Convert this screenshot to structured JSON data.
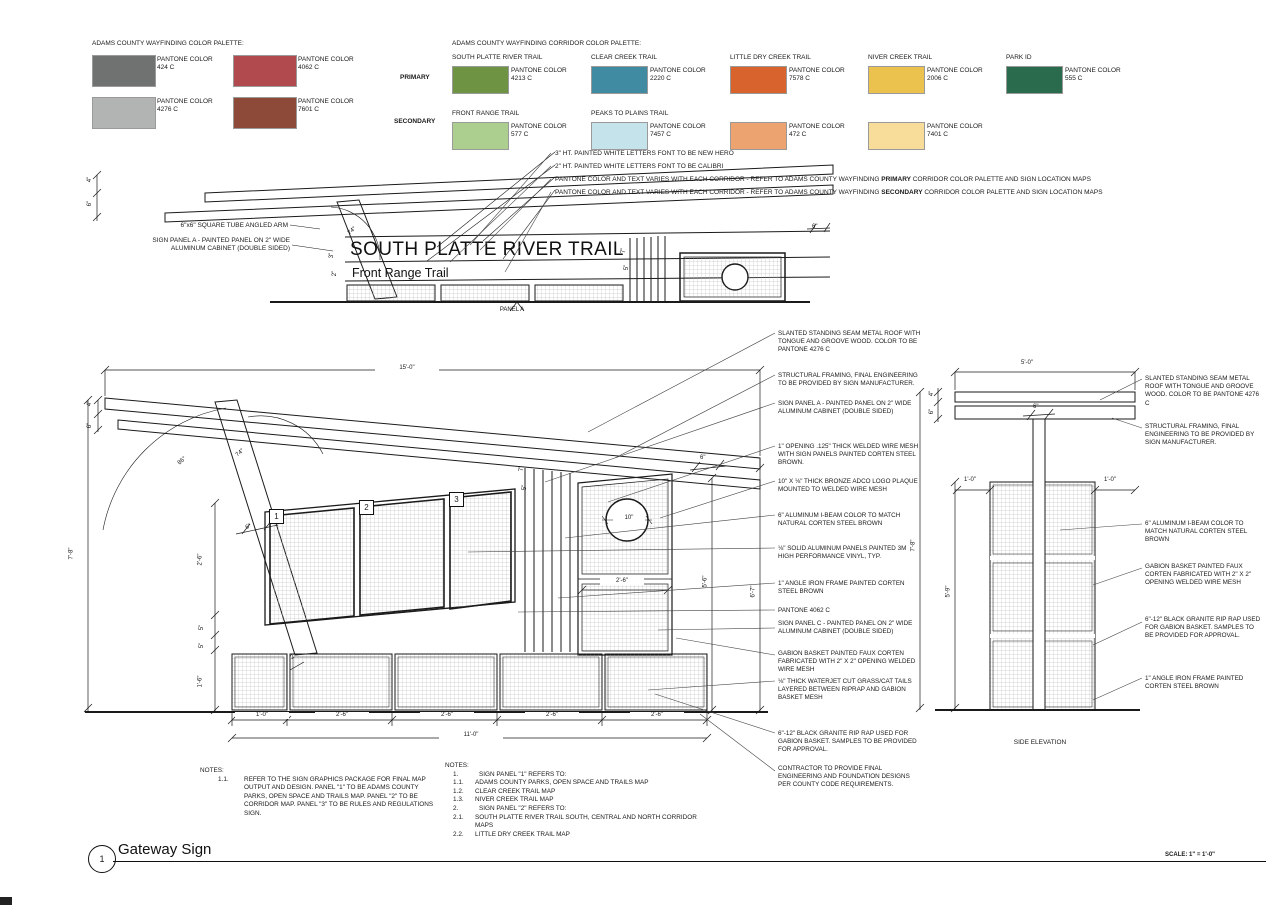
{
  "palette": {
    "title": "ADAMS COUNTY WAYFINDING COLOR PALETTE:",
    "swatches": [
      {
        "label": "PANTONE COLOR",
        "code": "424 C",
        "color": "#6f7271"
      },
      {
        "label": "PANTONE COLOR",
        "code": "4062 C",
        "color": "#b04a4f"
      },
      {
        "label": "PANTONE COLOR",
        "code": "4276 C",
        "color": "#b2b4b3"
      },
      {
        "label": "PANTONE COLOR",
        "code": "7601 C",
        "color": "#8d4a39"
      }
    ]
  },
  "corridor": {
    "title": "ADAMS COUNTY WAYFINDING CORRIDOR COLOR PALETTE:",
    "primary_label": "PRIMARY",
    "secondary_label": "SECONDARY",
    "primary": [
      {
        "trail": "SOUTH PLATTE RIVER TRAIL",
        "label": "PANTONE COLOR",
        "code": "4213 C",
        "color": "#6e9342"
      },
      {
        "trail": "CLEAR CREEK TRAIL",
        "label": "PANTONE COLOR",
        "code": "2220 C",
        "color": "#418ba2"
      },
      {
        "trail": "LITTLE DRY CREEK TRAIL",
        "label": "PANTONE COLOR",
        "code": "7578 C",
        "color": "#d9632c"
      },
      {
        "trail": "NIVER CREEK TRAIL",
        "label": "PANTONE COLOR",
        "code": "2006 C",
        "color": "#ecc24f"
      },
      {
        "trail": "PARK ID",
        "label": "PANTONE COLOR",
        "code": "555 C",
        "color": "#2a6b4d"
      }
    ],
    "secondary": [
      {
        "trail": "FRONT RANGE TRAIL",
        "label": "PANTONE COLOR",
        "code": "577 C",
        "color": "#accf90"
      },
      {
        "trail": "PEAKS TO PLAINS TRAIL",
        "label": "PANTONE COLOR",
        "code": "7457 C",
        "color": "#c5e3eb"
      },
      {
        "trail": "",
        "label": "PANTONE COLOR",
        "code": "472 C",
        "color": "#eca370"
      },
      {
        "trail": "",
        "label": "PANTONE COLOR",
        "code": "7401  C",
        "color": "#f7dd99"
      }
    ]
  },
  "top_callouts": {
    "c0": "3\" HT. PAINTED WHITE LETTERS FONT TO BE NEW HERO",
    "c1": "2\" HT. PAINTED WHITE LETTERS FONT TO BE CALIBRI",
    "c2_pre": "PANTONE COLOR AND TEXT VARIES WITH EACH CORRIDOR - REFER TO ADAMS COUNTY WAYFINDING ",
    "c2_bold": "PRIMARY",
    "c2_post": " CORRIDOR COLOR PALETTE AND SIGN LOCATION MAPS",
    "c3_pre": "PANTONE COLOR AND TEXT VARIES WITH EACH CORRIDOR - REFER TO ADAMS COUNTY WAYFINDING ",
    "c3_bold": "SECONDARY",
    "c3_post": " CORRIDOR COLOR PALETTE AND SIGN LOCATION MAPS"
  },
  "top_elev": {
    "arm_label": "6\"x6\" SQUARE TUBE ANGLED ARM",
    "panel_label1": "SIGN PANEL A - PAINTED PANEL ON 2\" WIDE",
    "panel_label2": "ALUMINUM CABINET (DOUBLE SIDED)",
    "sign_title": "SOUTH PLATTE RIVER TRAIL",
    "sign_subtitle": "Front Range Trail",
    "panel_a": "PANEL A",
    "dims": {
      "d4": "4\"",
      "d6": "6\"",
      "a74": "74°",
      "lh3": "3\"",
      "lh2": "2\"",
      "r6": "6\"",
      "s7": "7\"",
      "s5": "5\""
    }
  },
  "front": {
    "dims": {
      "top": "15'-0\"",
      "left": "7'-8\"",
      "roof4": "4\"",
      "roof6": "6\"",
      "a86": "86°",
      "a74": "74°",
      "arm": "6\"",
      "l1": "2'-6\"",
      "l2": "5\"",
      "l3": "5\"",
      "l4": "1'-6\"",
      "b0": "1'-0\"",
      "b1": "2'-6\"",
      "b2": "2'-6\"",
      "b3": "2'-6\"",
      "b4": "2'-6\"",
      "btotal": "11'-0\"",
      "r1": "5'-6\"",
      "r2": "6'-7\"",
      "mesh_w": "2'-6\"",
      "plaque": "10\"",
      "s7": "7\"",
      "s5": "5\"",
      "tr6": "6\"",
      "g2": "2\""
    },
    "panels": [
      "1",
      "2",
      "3"
    ]
  },
  "front_callouts": [
    "SLANTED STANDING SEAM METAL ROOF WITH TONGUE AND GROOVE WOOD. COLOR TO BE PANTONE 4276 C",
    "STRUCTURAL FRAMING, FINAL ENGINEERING TO BE PROVIDED BY SIGN MANUFACTURER.",
    "SIGN PANEL A - PAINTED PANEL ON 2\" WIDE ALUMINUM CABINET (DOUBLE SIDED)",
    "1\" OPENING .125\" THICK WELDED WIRE MESH WITH SIGN PANELS PAINTED CORTEN STEEL BROWN.",
    "10\" X ⅛\" THICK BRONZE ADCO LOGO PLAQUE MOUNTED TO WELDED WIRE MESH",
    "6\"  ALUMINUM  I-BEAM COLOR TO MATCH NATURAL CORTEN STEEL BROWN",
    "⅛\" SOLID ALUMINUM PANELS PAINTED 3M HIGH PERFORMANCE VINYL, TYP.",
    "1\" ANGLE IRON FRAME PAINTED CORTEN STEEL BROWN",
    "PANTONE 4062 C",
    "SIGN PANEL C - PAINTED PANEL ON 2\" WIDE ALUMINUM CABINET (DOUBLE SIDED)",
    "GABION BASKET PAINTED FAUX CORTEN FABRICATED WITH 2\" X 2\" OPENING WELDED WIRE MESH",
    "⅛\" THICK WATERJET CUT GRASS/CAT TAILS LAYERED BETWEEN RIPRAP AND GABION BASKET MESH",
    "6\"-12\" BLACK GRANITE RIP RAP USED FOR GABION BASKET. SAMPLES TO BE PROVIDED FOR APPROVAL.",
    "CONTRACTOR TO PROVIDE FINAL ENGINEERING AND FOUNDATION DESIGNS PER COUNTY CODE REQUIREMENTS."
  ],
  "side": {
    "dims": {
      "top": "5'-0\"",
      "r4": "4\"",
      "r6": "6\"",
      "beam": "6\"",
      "loff": "1'-0\"",
      "roff": "1'-0\"",
      "h": "7'-8\"",
      "gh": "5'-9\""
    },
    "caption": "SIDE ELEVATION"
  },
  "side_callouts": [
    "SLANTED STANDING SEAM METAL ROOF WITH TONGUE AND GROOVE WOOD. COLOR TO BE PANTONE 4276 C",
    "STRUCTURAL FRAMING, FINAL ENGINEERING TO BE PROVIDED BY SIGN MANUFACTURER.",
    "6\" ALUMINUM  I-BEAM COLOR TO MATCH NATURAL CORTEN STEEL BROWN",
    "GABION BASKET PAINTED FAUX CORTEN FABRICATED WITH 2\" X 2\" OPENING WELDED WIRE MESH",
    "6\"-12\" BLACK GRANITE RIP RAP USED FOR GABION BASKET. SAMPLES TO BE PROVIDED FOR APPROVAL.",
    "1\" ANGLE IRON FRAME PAINTED CORTEN STEEL BROWN"
  ],
  "notes_left": {
    "title": "NOTES:",
    "no": "1.1.",
    "text": "REFER TO THE SIGN GRAPHICS PACKAGE FOR FINAL MAP OUTPUT AND DESIGN. PANEL \"1\" TO BE ADAMS COUNTY PARKS, OPEN SPACE AND TRAILS MAP. PANEL \"2\" TO BE CORRIDOR MAP. PANEL \"3\" TO BE RULES AND REGULATIONS SIGN."
  },
  "notes_right": {
    "title": "NOTES:",
    "items": [
      {
        "no": "1.",
        "text": "SIGN PANEL \"1\" REFERS TO:"
      },
      {
        "no": "1.1.",
        "text": "ADAMS COUNTY PARKS, OPEN SPACE AND TRAILS MAP"
      },
      {
        "no": "1.2.",
        "text": "CLEAR CREEK TRAIL MAP"
      },
      {
        "no": "1.3.",
        "text": "NIVER CREEK TRAIL MAP"
      },
      {
        "no": "2.",
        "text": "SIGN PANEL \"2\" REFERS TO:"
      },
      {
        "no": "2.1.",
        "text": "SOUTH PLATTE RIVER TRAIL SOUTH, CENTRAL AND NORTH CORRIDOR MAPS"
      },
      {
        "no": "2.2.",
        "text": "LITTLE DRY CREEK TRAIL MAP"
      }
    ]
  },
  "titleblock": {
    "number": "1",
    "title": "Gateway Sign",
    "scale": "SCALE: 1\" = 1'-0\""
  }
}
